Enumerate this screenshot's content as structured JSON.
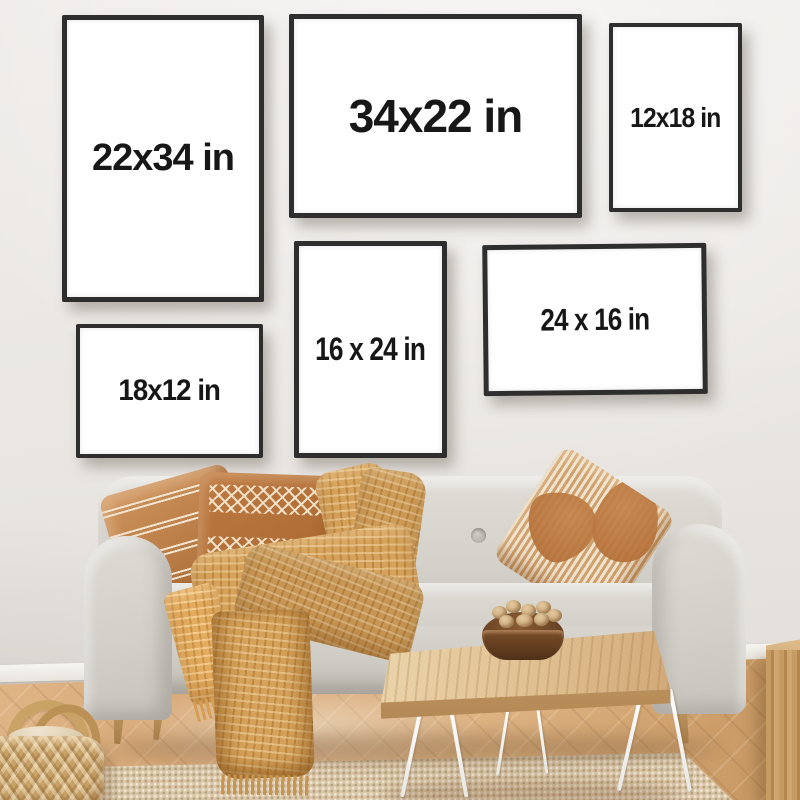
{
  "frames": [
    {
      "id": "22x34",
      "label": "22x34 in"
    },
    {
      "id": "34x22",
      "label": "34x22 in"
    },
    {
      "id": "12x18",
      "label": "12x18 in"
    },
    {
      "id": "16x24",
      "label": "16 x 24 in"
    },
    {
      "id": "24x16",
      "label": "24 x 16 in"
    },
    {
      "id": "18x12",
      "label": "18x12 in"
    }
  ],
  "colors": {
    "frame_border": "#2e2e2e",
    "label_text": "#171717",
    "frame_matte": "#ffffff",
    "wall": "#eae7e3",
    "floor_wood": "#d2a271",
    "sofa_fabric": "#d6d3cc",
    "pillow_camel": "#b5713a",
    "blanket_mustard": "#d6a158",
    "rug_jute": "#d9c6a7",
    "table_wood": "#e0c091",
    "hairpin_leg": "#ffffff",
    "bowl_walnut": "#5c3a1e"
  }
}
